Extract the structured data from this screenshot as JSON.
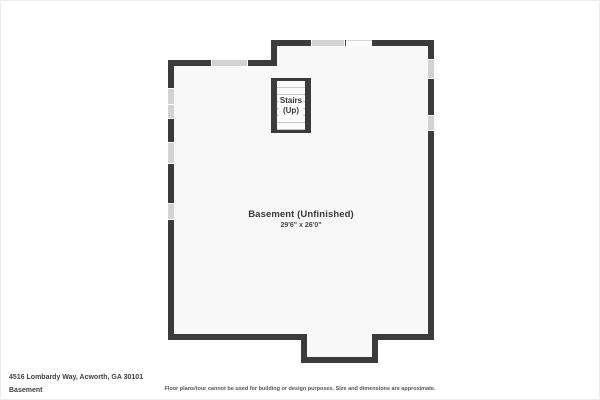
{
  "plan": {
    "room_label": "Basement (Unfinished)",
    "room_dimensions": "29'6\" x 26'0\"",
    "stairs": {
      "label_line1": "Stairs",
      "label_line2": "(Up)"
    },
    "colors": {
      "wall": "#3b3b3b",
      "window": "#d2d2d2",
      "floor": "#f8f8f8",
      "page_background": "#ffffff"
    }
  },
  "footer": {
    "address": "4516 Lombardy Way, Acworth, GA 30101",
    "floor_name": "Basement",
    "disclaimer": "Floor plans/tour cannot be used for building or design purposes. Size and dimensions are approximate."
  }
}
